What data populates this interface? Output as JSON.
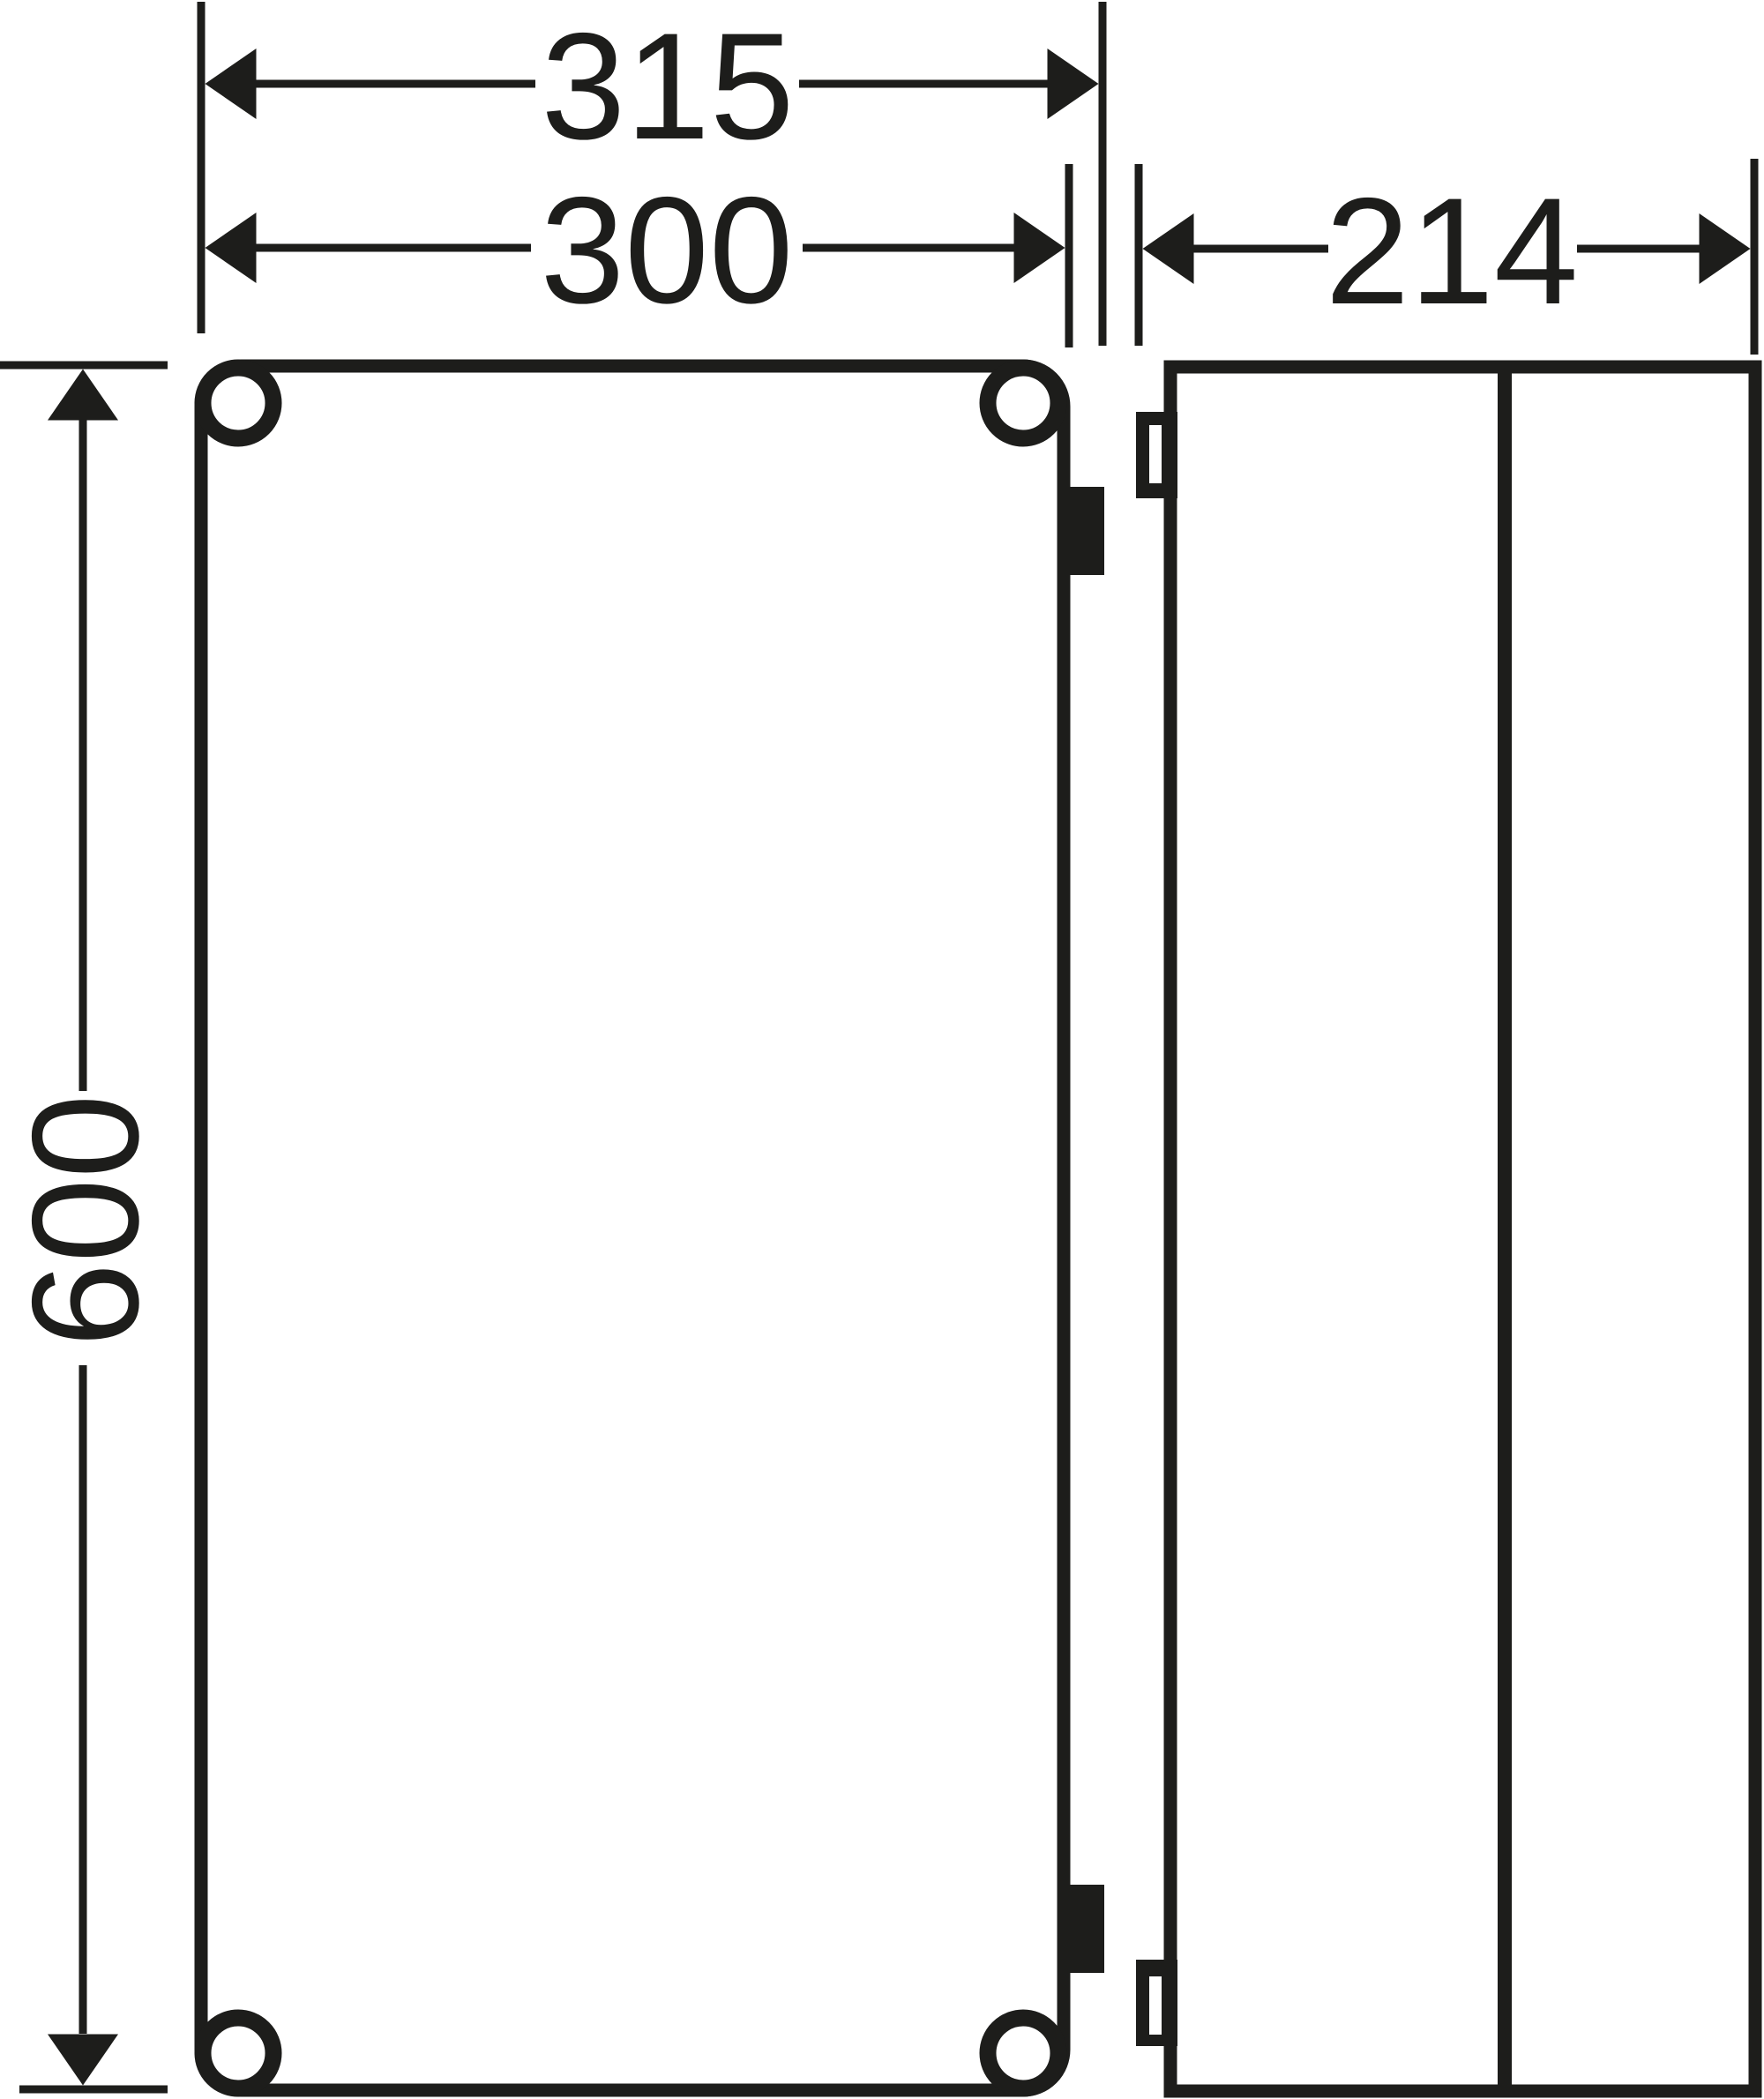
{
  "drawing": {
    "kind": "technical-dimension-drawing",
    "views": {
      "front_view_name": "front-view",
      "side_view_name": "side-view"
    }
  },
  "dimensions": {
    "overall_width": "315",
    "enclosure_width": "300",
    "depth": "214",
    "height": "600"
  },
  "colors": {
    "line": "#1d1d1b",
    "background": "#ffffff"
  }
}
